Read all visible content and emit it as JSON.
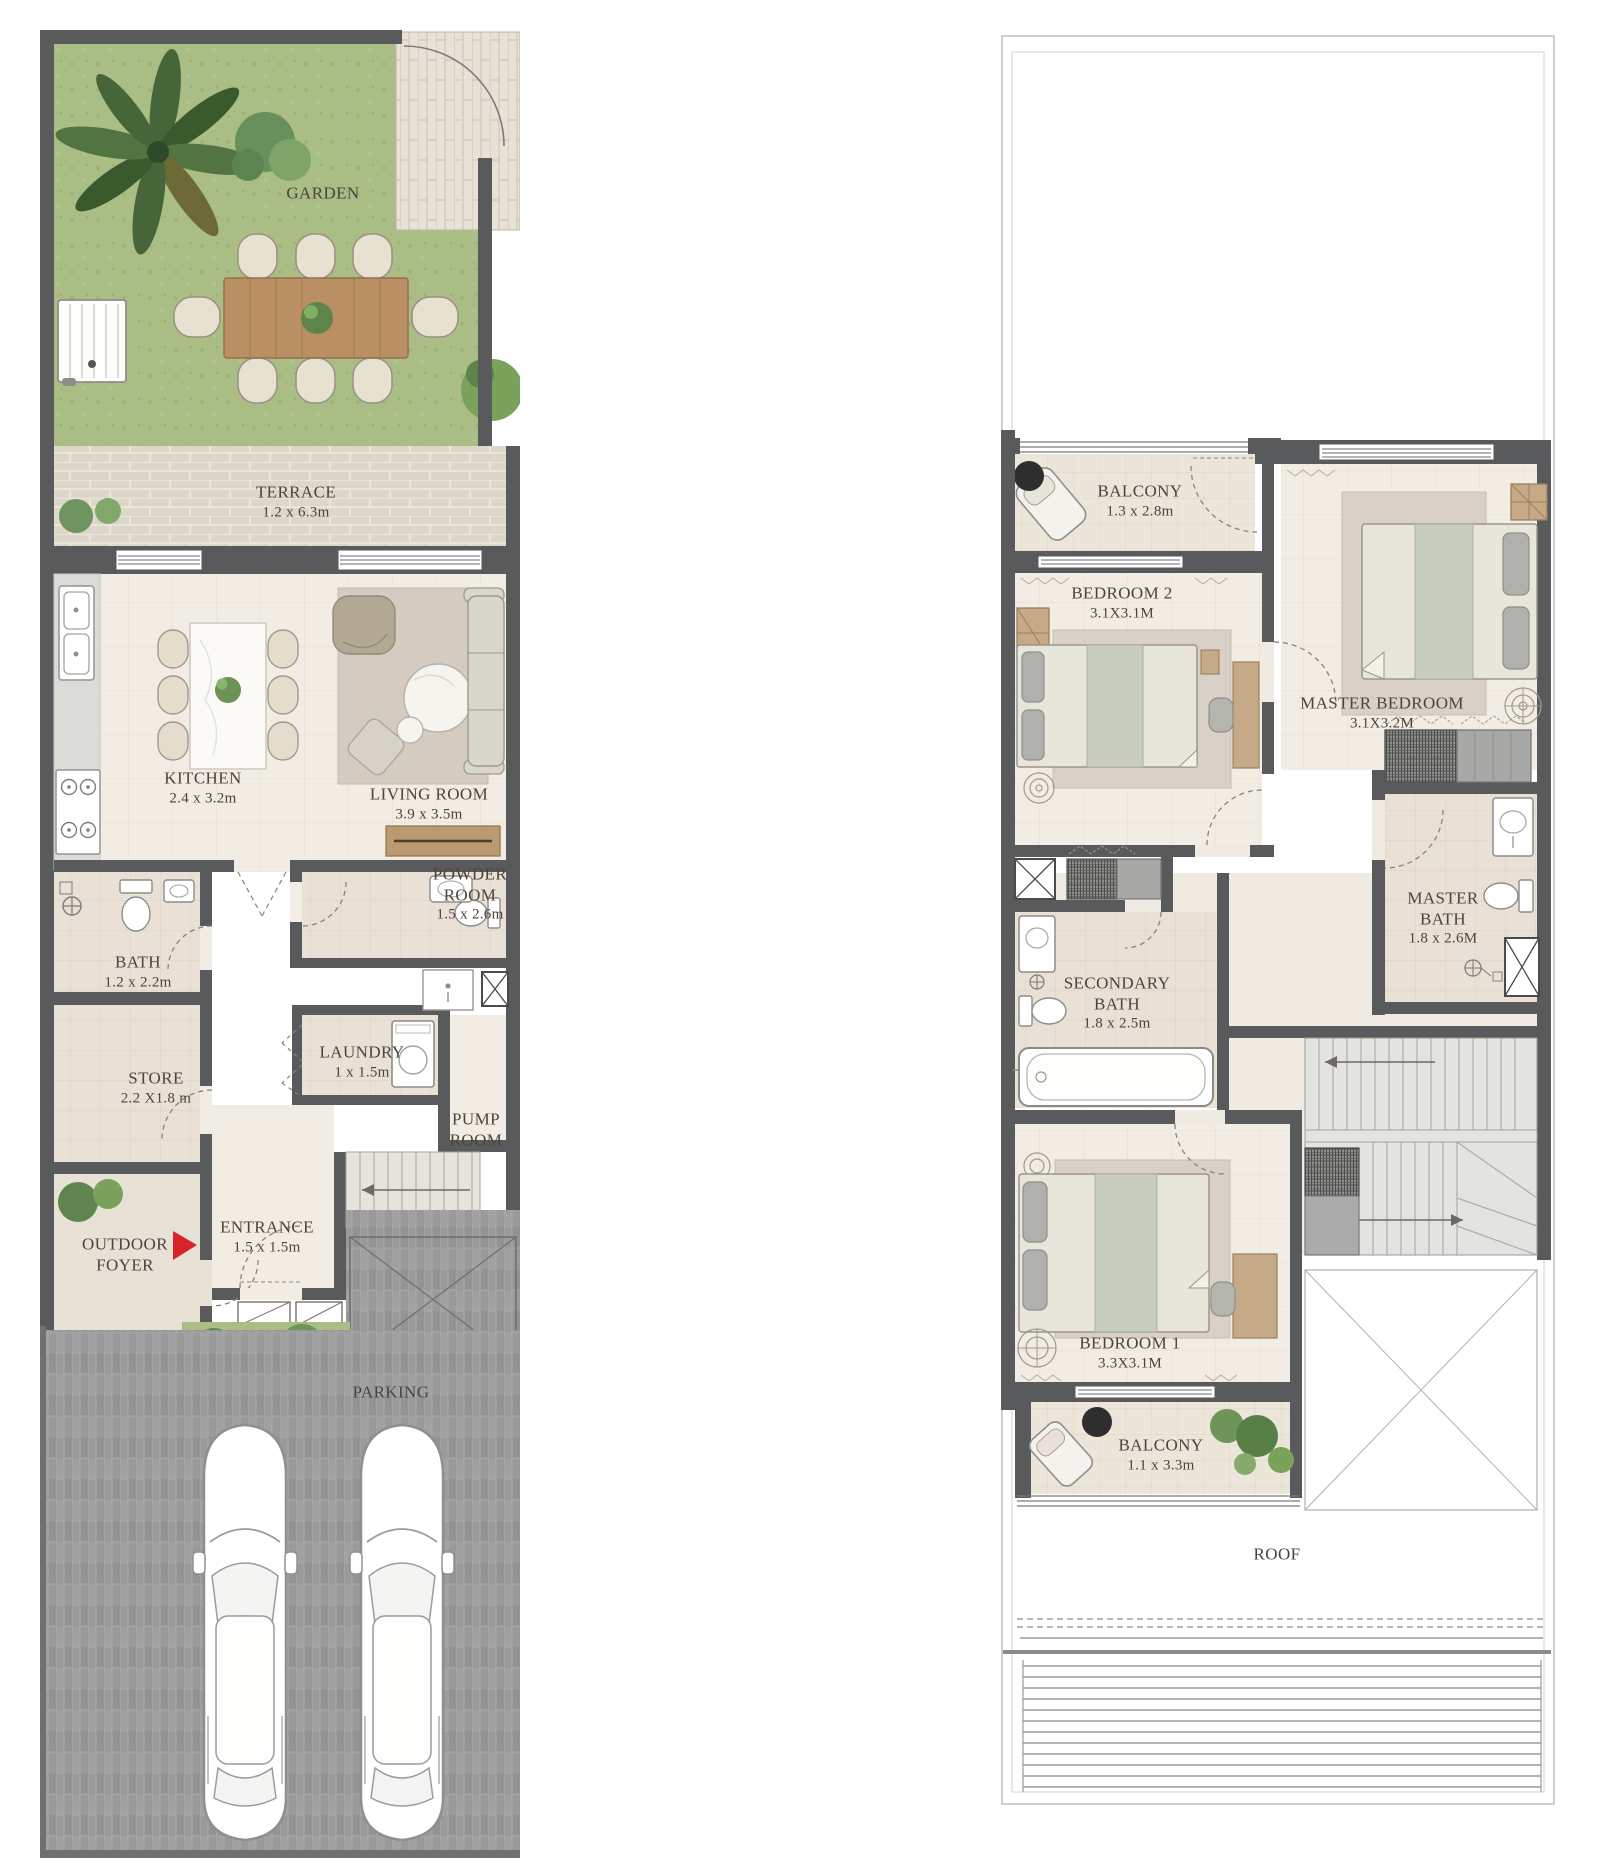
{
  "ground_floor": {
    "title": "Ground Floor",
    "rooms": [
      {
        "id": "garden",
        "name": "GARDEN",
        "dims": ""
      },
      {
        "id": "terrace",
        "name": "TERRACE",
        "dims": "1.2 x 6.3m"
      },
      {
        "id": "kitchen",
        "name": "KITCHEN",
        "dims": "2.4 x 3.2m"
      },
      {
        "id": "living_room",
        "name": "LIVING ROOM",
        "dims": "3.9 x 3.5m"
      },
      {
        "id": "powder_room",
        "name": "POWDER ROOM",
        "dims": "1.5 x 2.6m"
      },
      {
        "id": "bath",
        "name": "BATH",
        "dims": "1.2 x 2.2m"
      },
      {
        "id": "store",
        "name": "STORE",
        "dims": "2.2 X1.8 m"
      },
      {
        "id": "laundry",
        "name": "LAUNDRY",
        "dims": "1 x 1.5m"
      },
      {
        "id": "pump_room",
        "name": "PUMP ROOM",
        "dims": ""
      },
      {
        "id": "outdoor_foyer",
        "name": "OUTDOOR FOYER",
        "dims": ""
      },
      {
        "id": "entrance",
        "name": "ENTRANCE",
        "dims": "1.5 x 1.5m"
      },
      {
        "id": "parking",
        "name": "PARKING",
        "dims": ""
      }
    ]
  },
  "first_floor": {
    "title": "First Floor",
    "rooms": [
      {
        "id": "balcony_top",
        "name": "BALCONY",
        "dims": "1.3 x 2.8m"
      },
      {
        "id": "bedroom_2",
        "name": "BEDROOM 2",
        "dims": "3.1X3.1M"
      },
      {
        "id": "master_bedroom",
        "name": "MASTER BEDROOM",
        "dims": "3.1X3.2M"
      },
      {
        "id": "master_bath",
        "name": "MASTER BATH",
        "dims": "1.8 x 2.6M"
      },
      {
        "id": "secondary_bath",
        "name": "SECONDARY BATH",
        "dims": "1.8 x 2.5m"
      },
      {
        "id": "bedroom_1",
        "name": "BEDROOM 1",
        "dims": "3.3X3.1M"
      },
      {
        "id": "balcony_bottom",
        "name": "BALCONY",
        "dims": "1.1 x 3.3m"
      },
      {
        "id": "roof",
        "name": "ROOF",
        "dims": ""
      }
    ]
  },
  "icons": {
    "entry_arrow": "entry-direction-arrow"
  },
  "colors": {
    "wall": "#595a5c",
    "garden_green": "#a9bd84",
    "terrace_brick": "#ddd7c9",
    "interior_floor": "#f1ece4",
    "room_floor": "#e9e1d5",
    "parking_gray": "#9a9a9a",
    "accent_red": "#d9232a",
    "text": "#4c443a"
  }
}
